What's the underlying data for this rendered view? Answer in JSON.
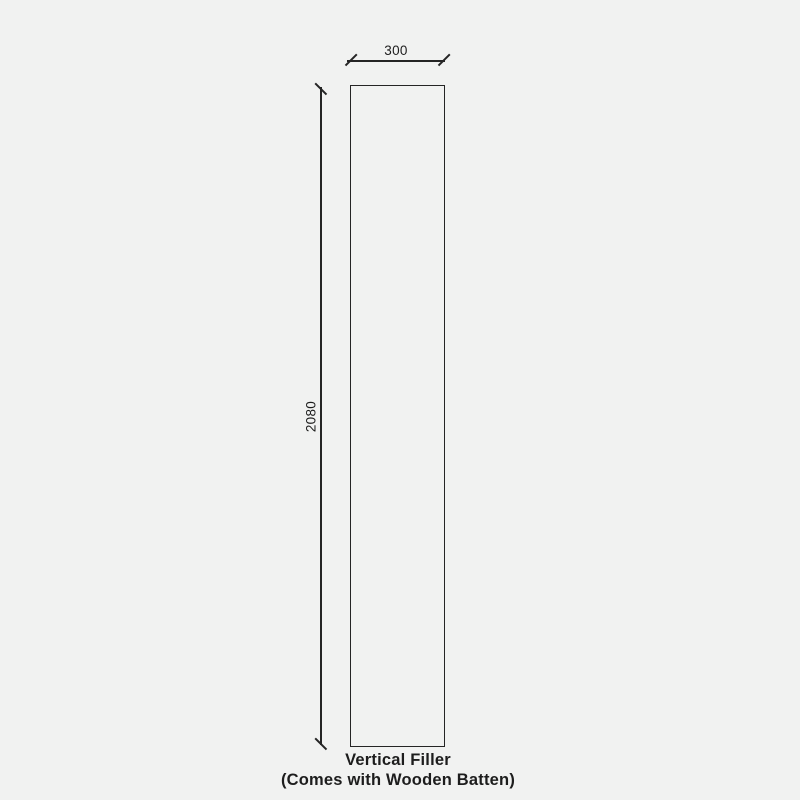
{
  "diagram": {
    "type": "technical-dimension-drawing",
    "part": {
      "caption_line1": "Vertical Filler",
      "caption_line2": "(Comes with Wooden Batten)"
    },
    "dimensions": {
      "width": {
        "label": "300",
        "orientation": "horizontal"
      },
      "height": {
        "label": "2080",
        "orientation": "vertical"
      }
    },
    "colors": {
      "background": "#f1f2f1",
      "line": "#252525",
      "text": "#1d1d1d"
    }
  }
}
